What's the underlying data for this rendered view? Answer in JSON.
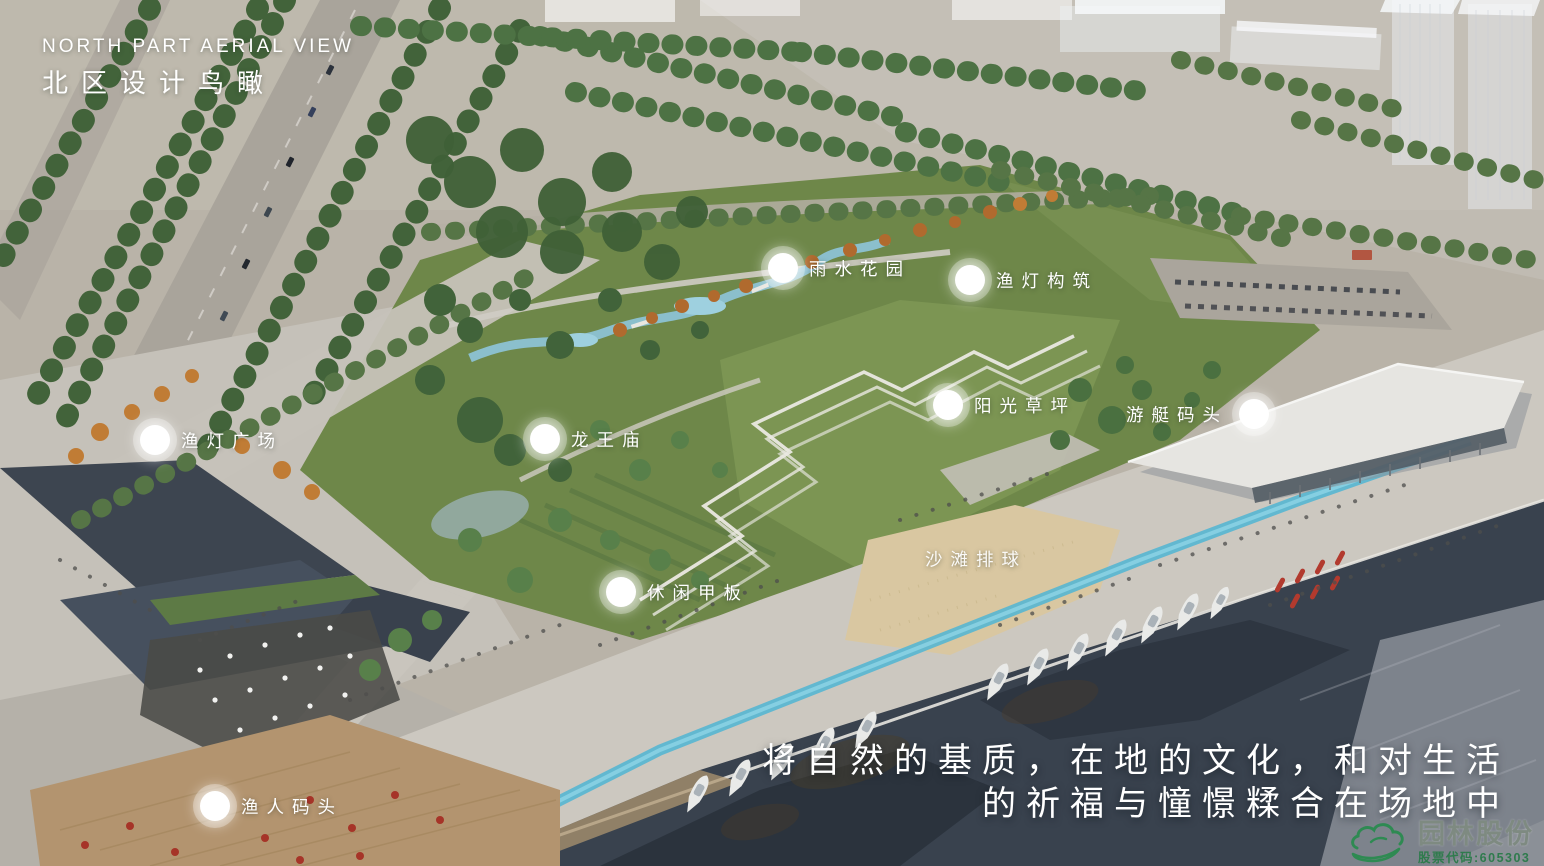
{
  "title": {
    "en": "NORTH PART AERIAL VIEW",
    "zh": "北区设计鸟瞰"
  },
  "callouts": [
    {
      "id": "rain-garden",
      "label": "雨水花园"
    },
    {
      "id": "fishing-lamp-structure",
      "label": "渔灯构筑"
    },
    {
      "id": "sunshine-lawn",
      "label": "阳光草坪"
    },
    {
      "id": "yacht-marina",
      "label": "游艇码头"
    },
    {
      "id": "fishing-lamp-plaza",
      "label": "渔灯广场"
    },
    {
      "id": "dragon-king-temple",
      "label": "龙王庙"
    },
    {
      "id": "beach-volleyball",
      "label": "沙滩排球"
    },
    {
      "id": "leisure-deck",
      "label": "休闲甲板"
    },
    {
      "id": "fishermans-wharf",
      "label": "渔人码头"
    }
  ],
  "caption": {
    "line1": "将自然的基质，在地的文化，和对生活",
    "line2": "的祈福与憧憬糅合在场地中"
  },
  "logo": {
    "company": "园林股份",
    "stock": "股票代码:605303"
  },
  "colors": {
    "logo_green": "#2e8a52",
    "stock_green": "#2f7b4d",
    "label_white": "#ffffff",
    "water_dark": "#39424e",
    "park_green": "#6e8749",
    "channel_cyan": "#57b6d2"
  }
}
